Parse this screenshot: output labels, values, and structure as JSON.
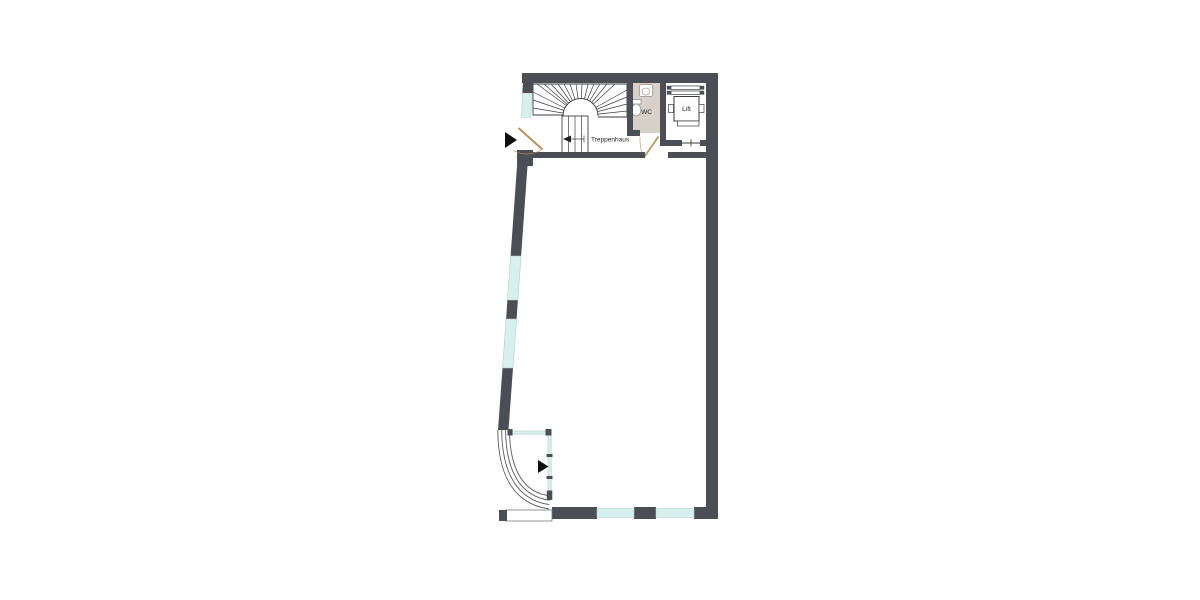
{
  "page": {
    "type": "architectural-floor-plan",
    "background": "#ffffff"
  },
  "labels": {
    "stairs": "Treppenhaus",
    "wc": "WC",
    "lift": "Lift"
  },
  "markers": {
    "entrance_top": "entry-direction-arrow",
    "entrance_bottom": "entry-direction-arrow"
  },
  "colors": {
    "background": "#ffffff",
    "wall": "#4b4e54",
    "outline": "#3e3e3e",
    "window_fill": "#d5f0ee",
    "window_edge": "#b8cecb",
    "door": "#b9905f",
    "wc_floor": "#d7d1ca",
    "fixture": "#8d8d8d",
    "curve": "#5a5a5a",
    "arrow": "#0f0f0f",
    "text": "#1f1f1f"
  }
}
